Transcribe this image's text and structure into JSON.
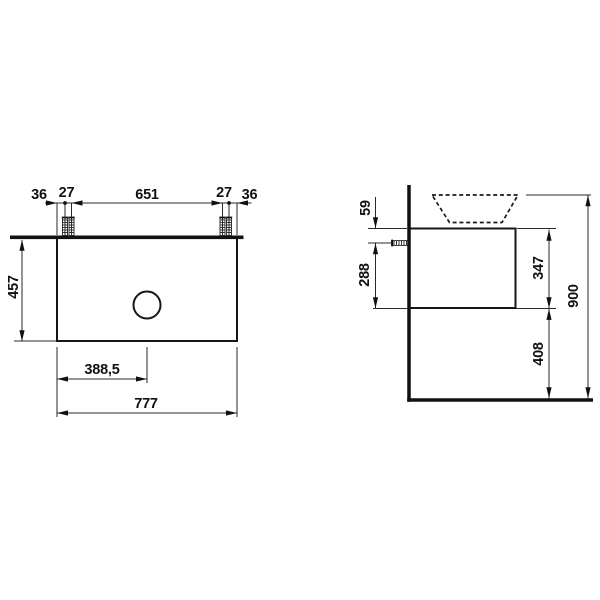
{
  "drawing_type": "vanity-unit-dimension-drawing",
  "units_note": "mm",
  "front": {
    "top_dims": [
      "36",
      "27",
      "651",
      "27",
      "36"
    ],
    "height": "457",
    "half_width": "388,5",
    "width": "777"
  },
  "side": {
    "top_to_bolt": "59",
    "bolt_to_bottom": "288",
    "body_height": "347",
    "bottom_to_floor": "408",
    "total_height": "900"
  },
  "colors": {
    "line": "#111111",
    "background": "#ffffff"
  }
}
